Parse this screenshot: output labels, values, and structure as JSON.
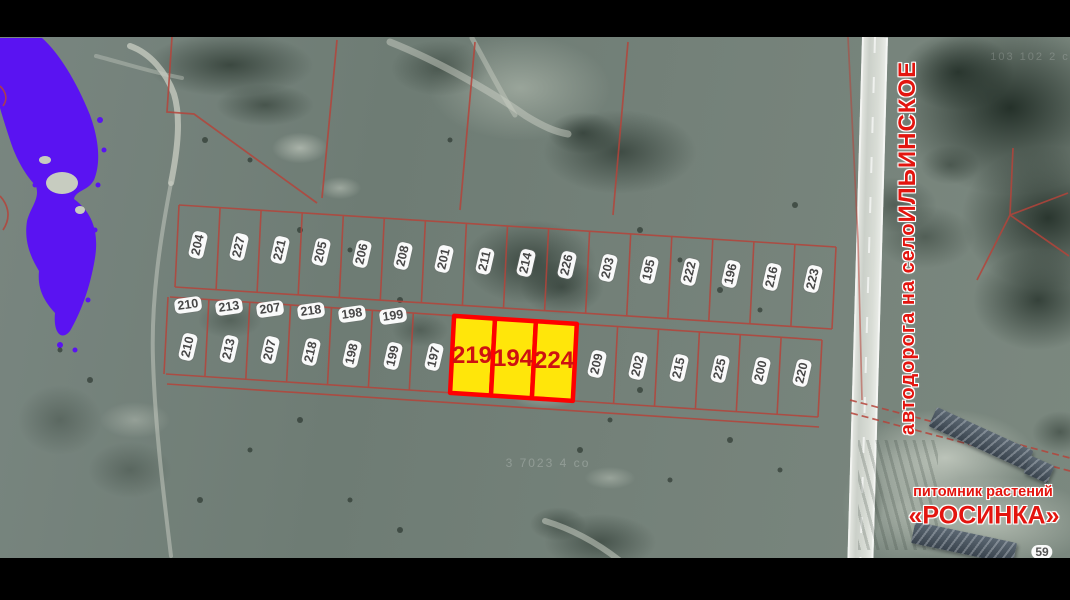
{
  "colors": {
    "water": "#5a13f2",
    "cadastral_line": "#b5443a",
    "highlight_fill": "#ffe60a",
    "highlight_border": "#ff0000",
    "road_text": "#e3150f",
    "nursery_text": "#d61616"
  },
  "plots": {
    "top_row": [
      "204",
      "227",
      "221",
      "205",
      "206",
      "208",
      "201",
      "211",
      "214",
      "226",
      "203",
      "195",
      "222",
      "196",
      "216",
      "223"
    ],
    "bottom_row_header": [
      "210",
      "213",
      "207",
      "218",
      "198",
      "199"
    ],
    "bottom_row_left": [
      "210",
      "213",
      "207",
      "218",
      "198",
      "199",
      "197"
    ],
    "highlighted": [
      "219",
      "194",
      "224"
    ],
    "bottom_row_right": [
      "209",
      "202",
      "215",
      "225",
      "200",
      "220"
    ]
  },
  "road": {
    "prefix": "автодорога на село ",
    "emphasis": "ИЛЬИНСКОЕ"
  },
  "nursery": {
    "line1": "питомник растений",
    "line2": "«РОСИНКА»"
  },
  "badge": "59",
  "watermarks": {
    "center": "3 7023 4 со",
    "top_right": "103 102 2 с"
  }
}
